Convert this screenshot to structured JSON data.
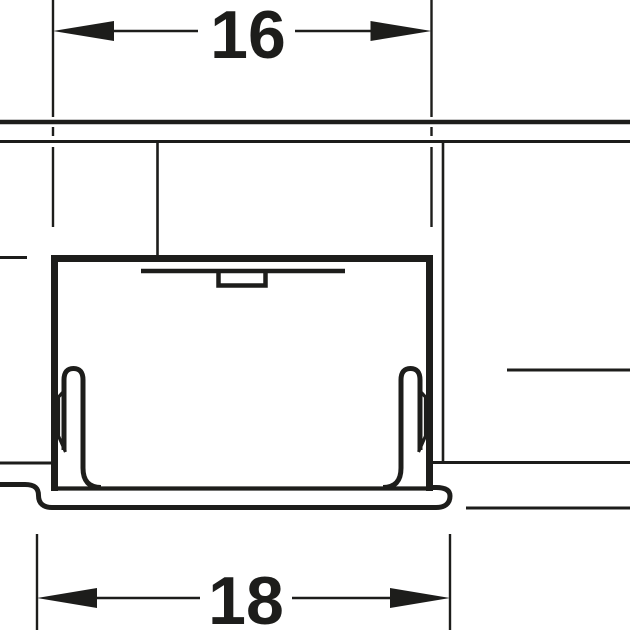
{
  "drawing": {
    "kind": "technical-cross-section",
    "line_color": "#1d1d1b",
    "background_color": "#ffffff"
  },
  "dimensions": {
    "top": {
      "label": "16"
    },
    "bottom": {
      "label": "18"
    }
  }
}
